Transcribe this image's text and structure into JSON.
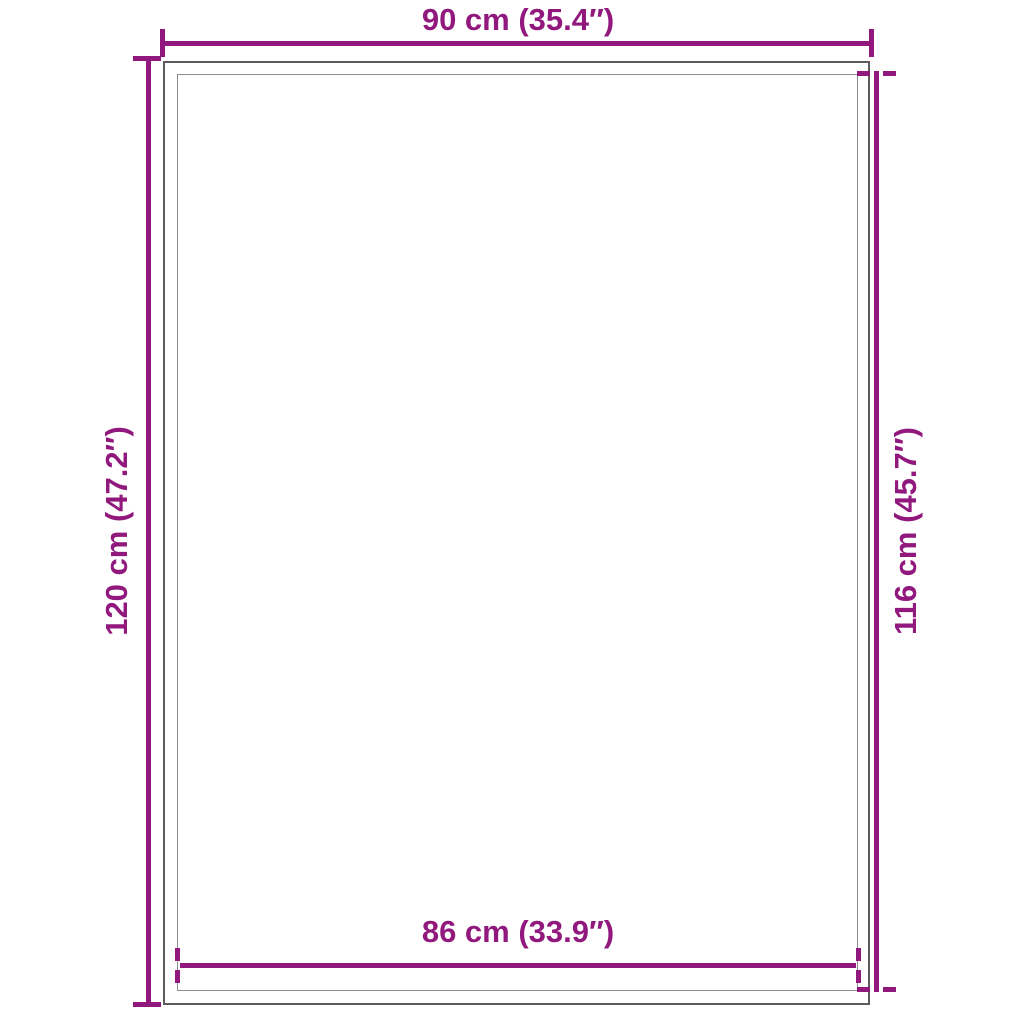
{
  "diagram": {
    "kind": "product-dimensions-diagram",
    "colors": {
      "accent": "#91197d",
      "outer_edge": "#5c5c5c",
      "inner_edge": "#8c8c8c",
      "background": "#ffffff"
    },
    "labels": {
      "top": "90 cm (35.4″)",
      "left": "120 cm (47.2″)",
      "right": "116 cm (45.7″)",
      "bottom": "86 cm (33.9″)"
    }
  }
}
